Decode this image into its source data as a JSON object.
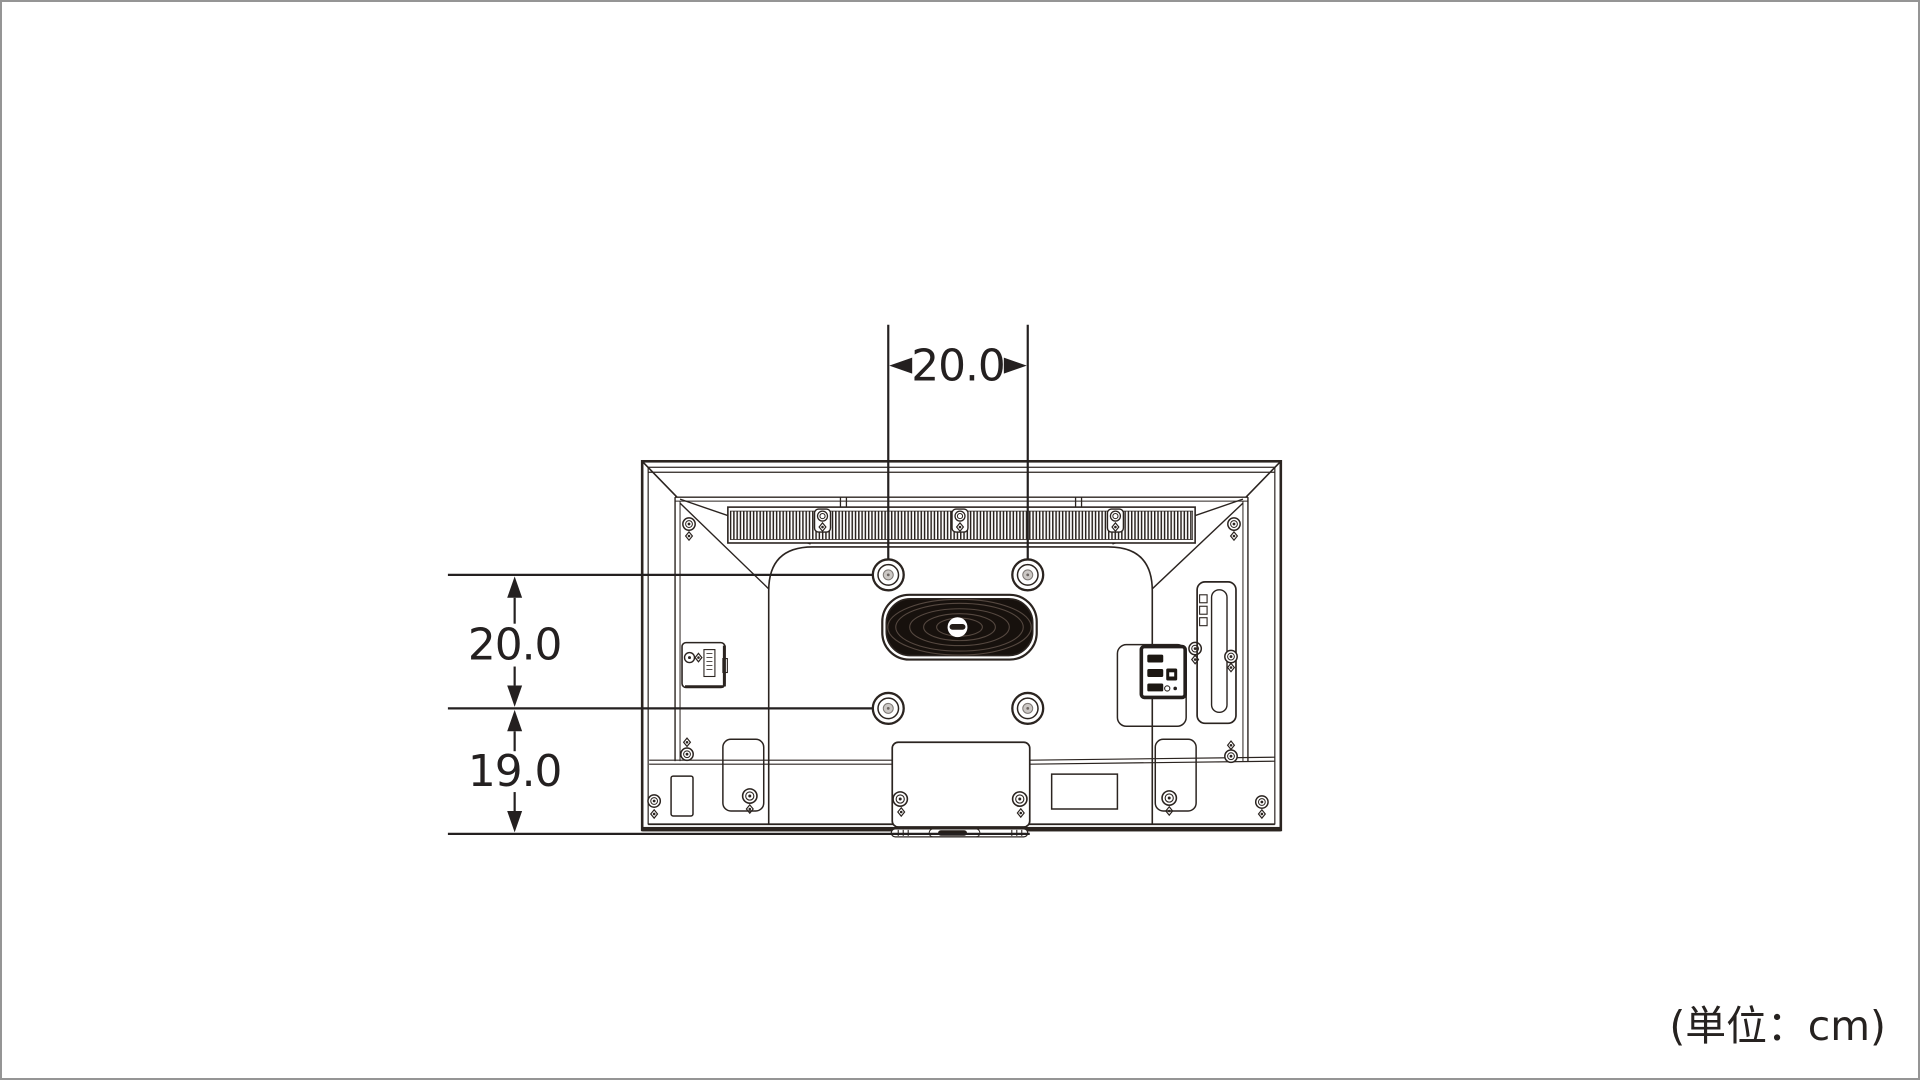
{
  "figure": {
    "type": "technical-dimension-drawing",
    "subject": "TV rear view with wall-mount hole spacing",
    "unit_note": "(単位：cm)",
    "dimensions": {
      "top_width": "20.0",
      "left_upper_height": "20.0",
      "left_lower_height": "19.0"
    }
  },
  "colors": {
    "background": "#ffffff",
    "page_border": "#959595",
    "line": "#2b2420",
    "dimension": "#242020",
    "dark_fill": "#17110d",
    "hole_center": "#ccc8c5"
  }
}
